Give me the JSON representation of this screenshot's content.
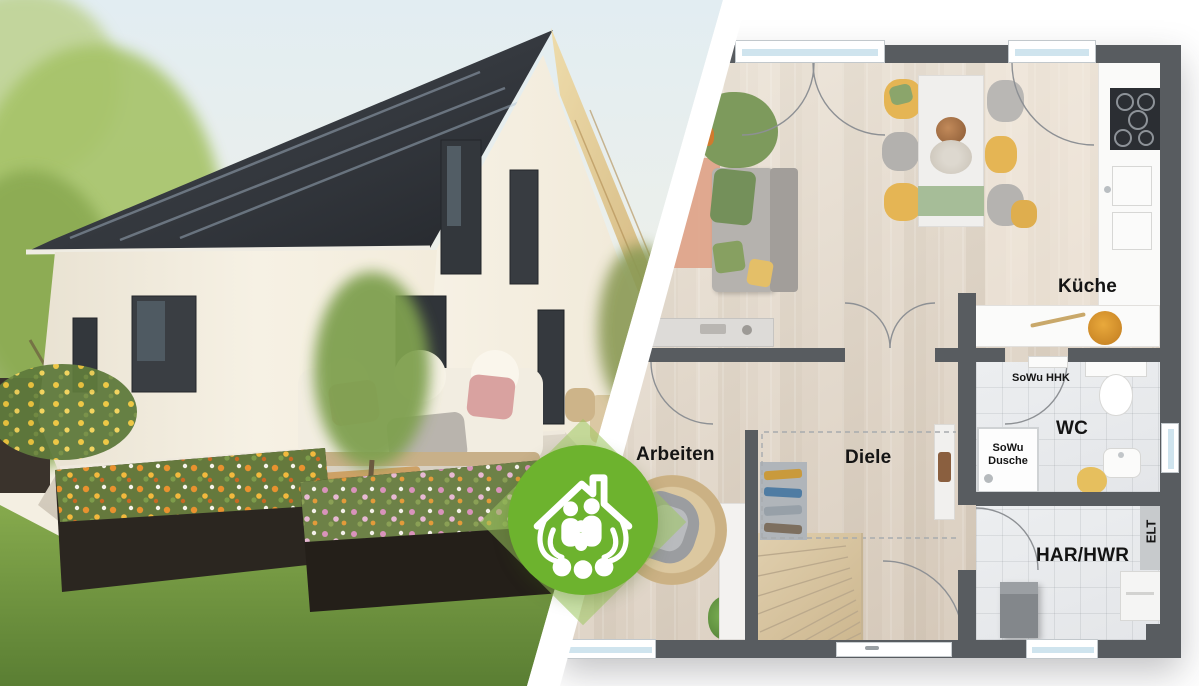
{
  "badge": {
    "icon": "house-family-in-hands-icon",
    "green": "#6db32e"
  },
  "floorplan": {
    "labels": {
      "kueche": "Küche",
      "wc": "WC",
      "arbeiten": "Arbeiten",
      "diele": "Diele",
      "har_hwr": "HAR/HWR",
      "elt": "ELT",
      "sowu_hhk": "SoWu HHK",
      "sowu_dusche_line1": "SoWu",
      "sowu_dusche_line2": "Dusche"
    },
    "colors": {
      "wall": "#585c60",
      "window_glass": "#cfe4ee",
      "wood_floor": "#d7cabb",
      "tile_floor": "#e9ebed",
      "label_text": "#141414"
    }
  }
}
